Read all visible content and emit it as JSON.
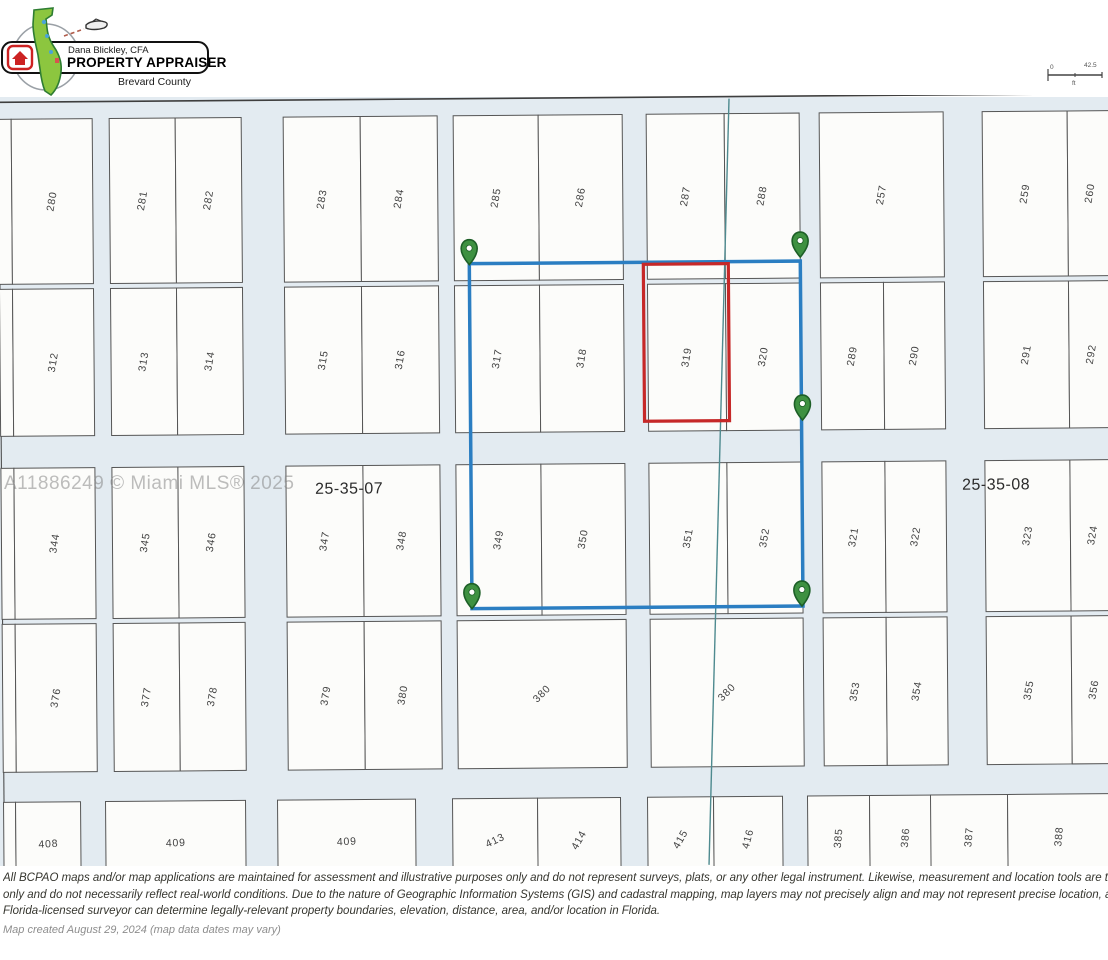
{
  "header": {
    "logo": {
      "name_line": "Dana Blickley, CFA",
      "title_line": "PROPERTY APPRAISER",
      "county_line": "Brevard County"
    },
    "scale_bar": {
      "left_label": "0",
      "right_label": "42.5",
      "unit": "ft"
    }
  },
  "map": {
    "background_color": "#e3ebf1",
    "parcel_fill": "#fcfcfa",
    "parcel_stroke": "#565656",
    "label_color": "#424242",
    "skew_deg": -0.45,
    "section_labels": [
      {
        "text": "25-35-07",
        "x": 315,
        "y": 492
      },
      {
        "text": "25-35-08",
        "x": 962,
        "y": 493
      }
    ],
    "watermark": "A11886249 © Miami MLS® 2025",
    "selection": {
      "x": 471,
      "y": 263,
      "w": 331,
      "h": 345,
      "color": "#2b7ec2"
    },
    "highlight_parcel": {
      "label": "319",
      "x": 645,
      "y": 265,
      "w": 85,
      "h": 157,
      "color": "#c62828"
    },
    "markers": [
      {
        "x": 471,
        "y": 264
      },
      {
        "x": 802,
        "y": 259
      },
      {
        "x": 803,
        "y": 422
      },
      {
        "x": 471,
        "y": 608
      },
      {
        "x": 801,
        "y": 608
      }
    ],
    "marker_fill": "#3e9141",
    "marker_stroke": "#1d5f27",
    "survey_line": {
      "x1": 732,
      "y1": 100,
      "x2": 706,
      "y2": 866,
      "color": "#4e8a8f"
    },
    "parcels": [
      {
        "l": "",
        "x": 1,
        "y": 115,
        "w": 13,
        "h": 165,
        "r": -80
      },
      {
        "l": "280",
        "x": 14,
        "y": 115,
        "w": 81,
        "h": 165,
        "r": -80
      },
      {
        "l": "281",
        "x": 112,
        "y": 115,
        "w": 66,
        "h": 165,
        "r": -80
      },
      {
        "l": "282",
        "x": 178,
        "y": 115,
        "w": 66,
        "h": 165,
        "r": -80
      },
      {
        "l": "283",
        "x": 286,
        "y": 115,
        "w": 77,
        "h": 165,
        "r": -80
      },
      {
        "l": "284",
        "x": 363,
        "y": 115,
        "w": 77,
        "h": 165,
        "r": -80
      },
      {
        "l": "285",
        "x": 456,
        "y": 115,
        "w": 85,
        "h": 165,
        "r": -80
      },
      {
        "l": "286",
        "x": 541,
        "y": 115,
        "w": 84,
        "h": 165,
        "r": -80
      },
      {
        "l": "287",
        "x": 649,
        "y": 115,
        "w": 78,
        "h": 165,
        "r": -80
      },
      {
        "l": "288",
        "x": 727,
        "y": 115,
        "w": 75,
        "h": 165,
        "r": -80
      },
      {
        "l": "257",
        "x": 822,
        "y": 115,
        "w": 124,
        "h": 165,
        "r": -80
      },
      {
        "l": "259",
        "x": 985,
        "y": 115,
        "w": 85,
        "h": 165,
        "r": -80
      },
      {
        "l": "260",
        "x": 1070,
        "y": 115,
        "w": 45,
        "h": 165,
        "r": -80
      },
      {
        "l": "",
        "x": 1,
        "y": 285,
        "w": 13,
        "h": 147,
        "r": -80
      },
      {
        "l": "312",
        "x": 14,
        "y": 285,
        "w": 81,
        "h": 147,
        "r": -80
      },
      {
        "l": "313",
        "x": 112,
        "y": 285,
        "w": 66,
        "h": 147,
        "r": -80
      },
      {
        "l": "314",
        "x": 178,
        "y": 285,
        "w": 66,
        "h": 147,
        "r": -80
      },
      {
        "l": "315",
        "x": 286,
        "y": 285,
        "w": 77,
        "h": 147,
        "r": -80
      },
      {
        "l": "316",
        "x": 363,
        "y": 285,
        "w": 77,
        "h": 147,
        "r": -80
      },
      {
        "l": "317",
        "x": 456,
        "y": 285,
        "w": 85,
        "h": 147,
        "r": -80
      },
      {
        "l": "318",
        "x": 541,
        "y": 285,
        "w": 84,
        "h": 147,
        "r": -80
      },
      {
        "l": "319",
        "x": 649,
        "y": 285,
        "w": 78,
        "h": 147,
        "r": -80
      },
      {
        "l": "320",
        "x": 727,
        "y": 285,
        "w": 75,
        "h": 147,
        "r": -80
      },
      {
        "l": "289",
        "x": 822,
        "y": 285,
        "w": 63,
        "h": 147,
        "r": -80
      },
      {
        "l": "290",
        "x": 885,
        "y": 285,
        "w": 61,
        "h": 147,
        "r": -80
      },
      {
        "l": "291",
        "x": 985,
        "y": 285,
        "w": 85,
        "h": 147,
        "r": -80
      },
      {
        "l": "292",
        "x": 1070,
        "y": 285,
        "w": 45,
        "h": 147,
        "r": -80
      },
      {
        "l": "",
        "x": 1,
        "y": 464,
        "w": 13,
        "h": 151,
        "r": -80
      },
      {
        "l": "344",
        "x": 14,
        "y": 464,
        "w": 81,
        "h": 151,
        "r": -80
      },
      {
        "l": "345",
        "x": 112,
        "y": 464,
        "w": 66,
        "h": 151,
        "r": -80
      },
      {
        "l": "346",
        "x": 178,
        "y": 464,
        "w": 66,
        "h": 151,
        "r": -80
      },
      {
        "l": "347",
        "x": 286,
        "y": 464,
        "w": 77,
        "h": 151,
        "r": -80
      },
      {
        "l": "348",
        "x": 363,
        "y": 464,
        "w": 77,
        "h": 151,
        "r": -80
      },
      {
        "l": "349",
        "x": 456,
        "y": 464,
        "w": 85,
        "h": 151,
        "r": -80
      },
      {
        "l": "350",
        "x": 541,
        "y": 464,
        "w": 84,
        "h": 151,
        "r": -80
      },
      {
        "l": "351",
        "x": 649,
        "y": 464,
        "w": 78,
        "h": 151,
        "r": -80
      },
      {
        "l": "352",
        "x": 727,
        "y": 464,
        "w": 75,
        "h": 151,
        "r": -80
      },
      {
        "l": "321",
        "x": 822,
        "y": 464,
        "w": 63,
        "h": 151,
        "r": -80
      },
      {
        "l": "322",
        "x": 885,
        "y": 464,
        "w": 61,
        "h": 151,
        "r": -80
      },
      {
        "l": "323",
        "x": 985,
        "y": 464,
        "w": 85,
        "h": 151,
        "r": -80
      },
      {
        "l": "324",
        "x": 1070,
        "y": 464,
        "w": 45,
        "h": 151,
        "r": -80
      },
      {
        "l": "",
        "x": 1,
        "y": 620,
        "w": 13,
        "h": 148,
        "r": -80
      },
      {
        "l": "376",
        "x": 14,
        "y": 620,
        "w": 81,
        "h": 148,
        "r": -80
      },
      {
        "l": "377",
        "x": 112,
        "y": 620,
        "w": 66,
        "h": 148,
        "r": -80
      },
      {
        "l": "378",
        "x": 178,
        "y": 620,
        "w": 66,
        "h": 148,
        "r": -80
      },
      {
        "l": "379",
        "x": 286,
        "y": 620,
        "w": 77,
        "h": 148,
        "r": -80
      },
      {
        "l": "380",
        "x": 363,
        "y": 620,
        "w": 77,
        "h": 148,
        "r": -80
      },
      {
        "l": "380",
        "x": 456,
        "y": 620,
        "w": 169,
        "h": 148,
        "r": -45
      },
      {
        "l": "380",
        "x": 649,
        "y": 620,
        "w": 153,
        "h": 148,
        "r": -45
      },
      {
        "l": "353",
        "x": 822,
        "y": 620,
        "w": 63,
        "h": 148,
        "r": -80
      },
      {
        "l": "354",
        "x": 885,
        "y": 620,
        "w": 61,
        "h": 148,
        "r": -80
      },
      {
        "l": "355",
        "x": 985,
        "y": 620,
        "w": 85,
        "h": 148,
        "r": -80
      },
      {
        "l": "356",
        "x": 1070,
        "y": 620,
        "w": 45,
        "h": 148,
        "r": -80
      },
      {
        "l": "",
        "x": 1,
        "y": 798,
        "w": 12,
        "h": 85,
        "r": 0
      },
      {
        "l": "408",
        "x": 13,
        "y": 798,
        "w": 65,
        "h": 85,
        "r": -3
      },
      {
        "l": "409",
        "x": 103,
        "y": 798,
        "w": 140,
        "h": 85,
        "r": -2
      },
      {
        "l": "409",
        "x": 275,
        "y": 798,
        "w": 138,
        "h": 85,
        "r": -2
      },
      {
        "l": "413",
        "x": 450,
        "y": 798,
        "w": 85,
        "h": 85,
        "r": -25
      },
      {
        "l": "414",
        "x": 535,
        "y": 798,
        "w": 83,
        "h": 85,
        "r": -60
      },
      {
        "l": "415",
        "x": 645,
        "y": 798,
        "w": 66,
        "h": 85,
        "r": -60
      },
      {
        "l": "416",
        "x": 711,
        "y": 798,
        "w": 69,
        "h": 85,
        "r": -75
      },
      {
        "l": "385",
        "x": 805,
        "y": 798,
        "w": 62,
        "h": 85,
        "r": -85
      },
      {
        "l": "386",
        "x": 867,
        "y": 798,
        "w": 72,
        "h": 85,
        "r": -85
      },
      {
        "l": "387",
        "x": 928,
        "y": 798,
        "w": 77,
        "h": 85,
        "r": -85
      },
      {
        "l": "388",
        "x": 1005,
        "y": 798,
        "w": 103,
        "h": 85,
        "r": -85
      }
    ]
  },
  "disclaimer": {
    "line1": "All BCPAO maps and/or map applications are maintained for assessment and illustrative purposes only and do not represent surveys, plats, or any other legal instrument. Likewise, measurement and location tools are t",
    "line2": "only and do not necessarily reflect real-world conditions. Due to the nature of Geographic Information Systems (GIS) and cadastral mapping, map layers may not precisely align and may not represent precise location, a",
    "line3": "Florida-licensed surveyor can determine legally-relevant property boundaries, elevation, distance, area, and/or location in Florida."
  },
  "footer": "Map created August 29, 2024 (map data dates may vary)"
}
